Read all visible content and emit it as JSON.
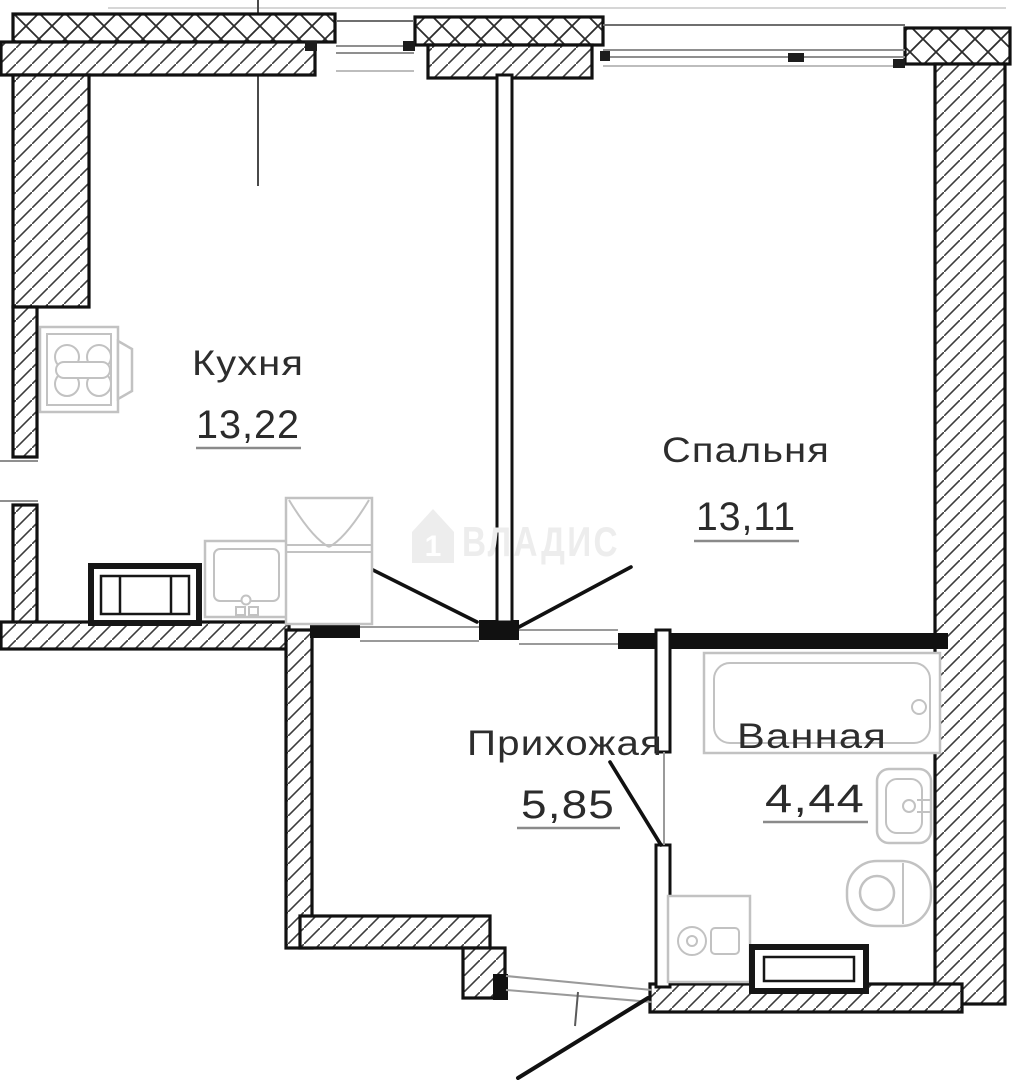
{
  "plan": {
    "type": "apartment-floor-plan",
    "watermark": {
      "brand": "ВЛАДИС",
      "icon": "house-icon",
      "icon_label": "1"
    },
    "rooms": [
      {
        "id": "kitchen",
        "label": "Кухня",
        "area": "13,22"
      },
      {
        "id": "bedroom",
        "label": "Спальня",
        "area": "13,11"
      },
      {
        "id": "hallway",
        "label": "Прихожая",
        "area": "5,85"
      },
      {
        "id": "bathroom",
        "label": "Ванная",
        "area": "4,44"
      }
    ],
    "fixtures": {
      "kitchen": [
        "stove-icon",
        "counter-icon",
        "sink-icon",
        "cabinet-double-door-icon"
      ],
      "bathroom": [
        "bathtub-icon",
        "wash-basin-icon",
        "toilet-icon",
        "washing-machine-icon",
        "radiator-icon"
      ]
    },
    "colors": {
      "wall": "#111111",
      "hatch": "#3c3c3c",
      "window": "#9a9a9a",
      "fixture_outline": "#c2c2c2",
      "dark_appliance": "#161616",
      "label": "#2d2d2d",
      "underline": "#8a8a8a",
      "watermark": "#ededed",
      "background": "#ffffff"
    }
  }
}
